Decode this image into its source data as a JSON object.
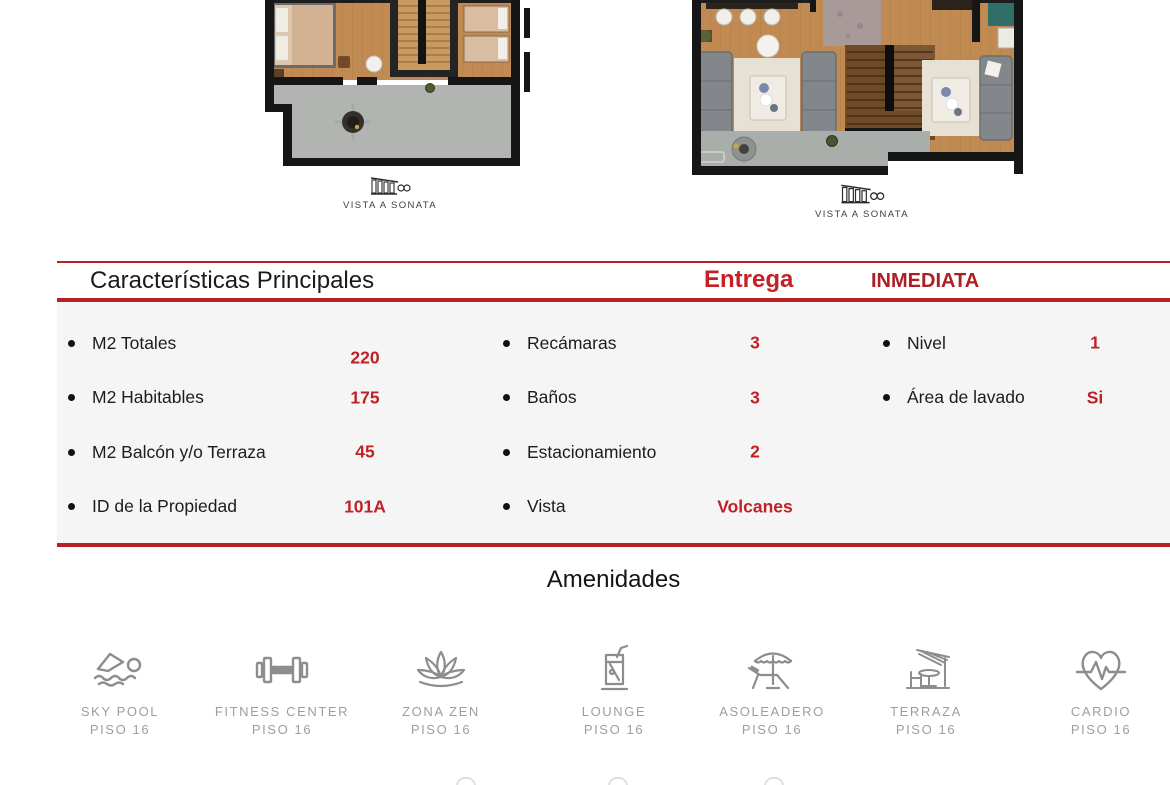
{
  "plans": {
    "left": {
      "caption": "VISTA A SONATA"
    },
    "right": {
      "caption": "VISTA A SONATA"
    }
  },
  "features": {
    "title": "Características Principales",
    "delivery_label": "Entrega",
    "delivery_status": "INMEDIATA",
    "col1": [
      {
        "label": "M2 Totales",
        "value": "220"
      },
      {
        "label": "M2 Habitables",
        "value": "175"
      },
      {
        "label": "M2 Balcón y/o Terraza",
        "value": "45"
      },
      {
        "label": "ID de la Propiedad",
        "value": "101A"
      }
    ],
    "col2": [
      {
        "label": "Recámaras",
        "value": "3"
      },
      {
        "label": "Baños",
        "value": "3"
      },
      {
        "label": "Estacionamiento",
        "value": "2"
      },
      {
        "label": "Vista",
        "value": "Volcanes"
      }
    ],
    "col3": [
      {
        "label": "Nivel",
        "value": "1"
      },
      {
        "label": "Área de lavado",
        "value": "Si"
      }
    ]
  },
  "amenities": {
    "title": "Amenidades",
    "items": [
      {
        "name": "SKY POOL",
        "floor": "PISO 16",
        "icon": "swimmer-icon"
      },
      {
        "name": "FITNESS CENTER",
        "floor": "PISO 16",
        "icon": "dumbbell-icon"
      },
      {
        "name": "ZONA ZEN",
        "floor": "PISO 16",
        "icon": "lotus-icon"
      },
      {
        "name": "LOUNGE",
        "floor": "PISO 16",
        "icon": "drink-glass-icon"
      },
      {
        "name": "ASOLEADERO",
        "floor": "PISO 16",
        "icon": "parasol-lounger-icon"
      },
      {
        "name": "TERRAZA",
        "floor": "PISO 16",
        "icon": "terrace-table-icon"
      },
      {
        "name": "CARDIO",
        "floor": "PISO 16",
        "icon": "heart-pulse-icon"
      }
    ]
  },
  "colors": {
    "accent_red": "#b82025",
    "value_red": "#bf2127",
    "delivery_red": "#c42026",
    "panel_gray": "#f5f5f5",
    "icon_gray": "#8d8d8d",
    "label_gray": "#9e9e9e"
  }
}
